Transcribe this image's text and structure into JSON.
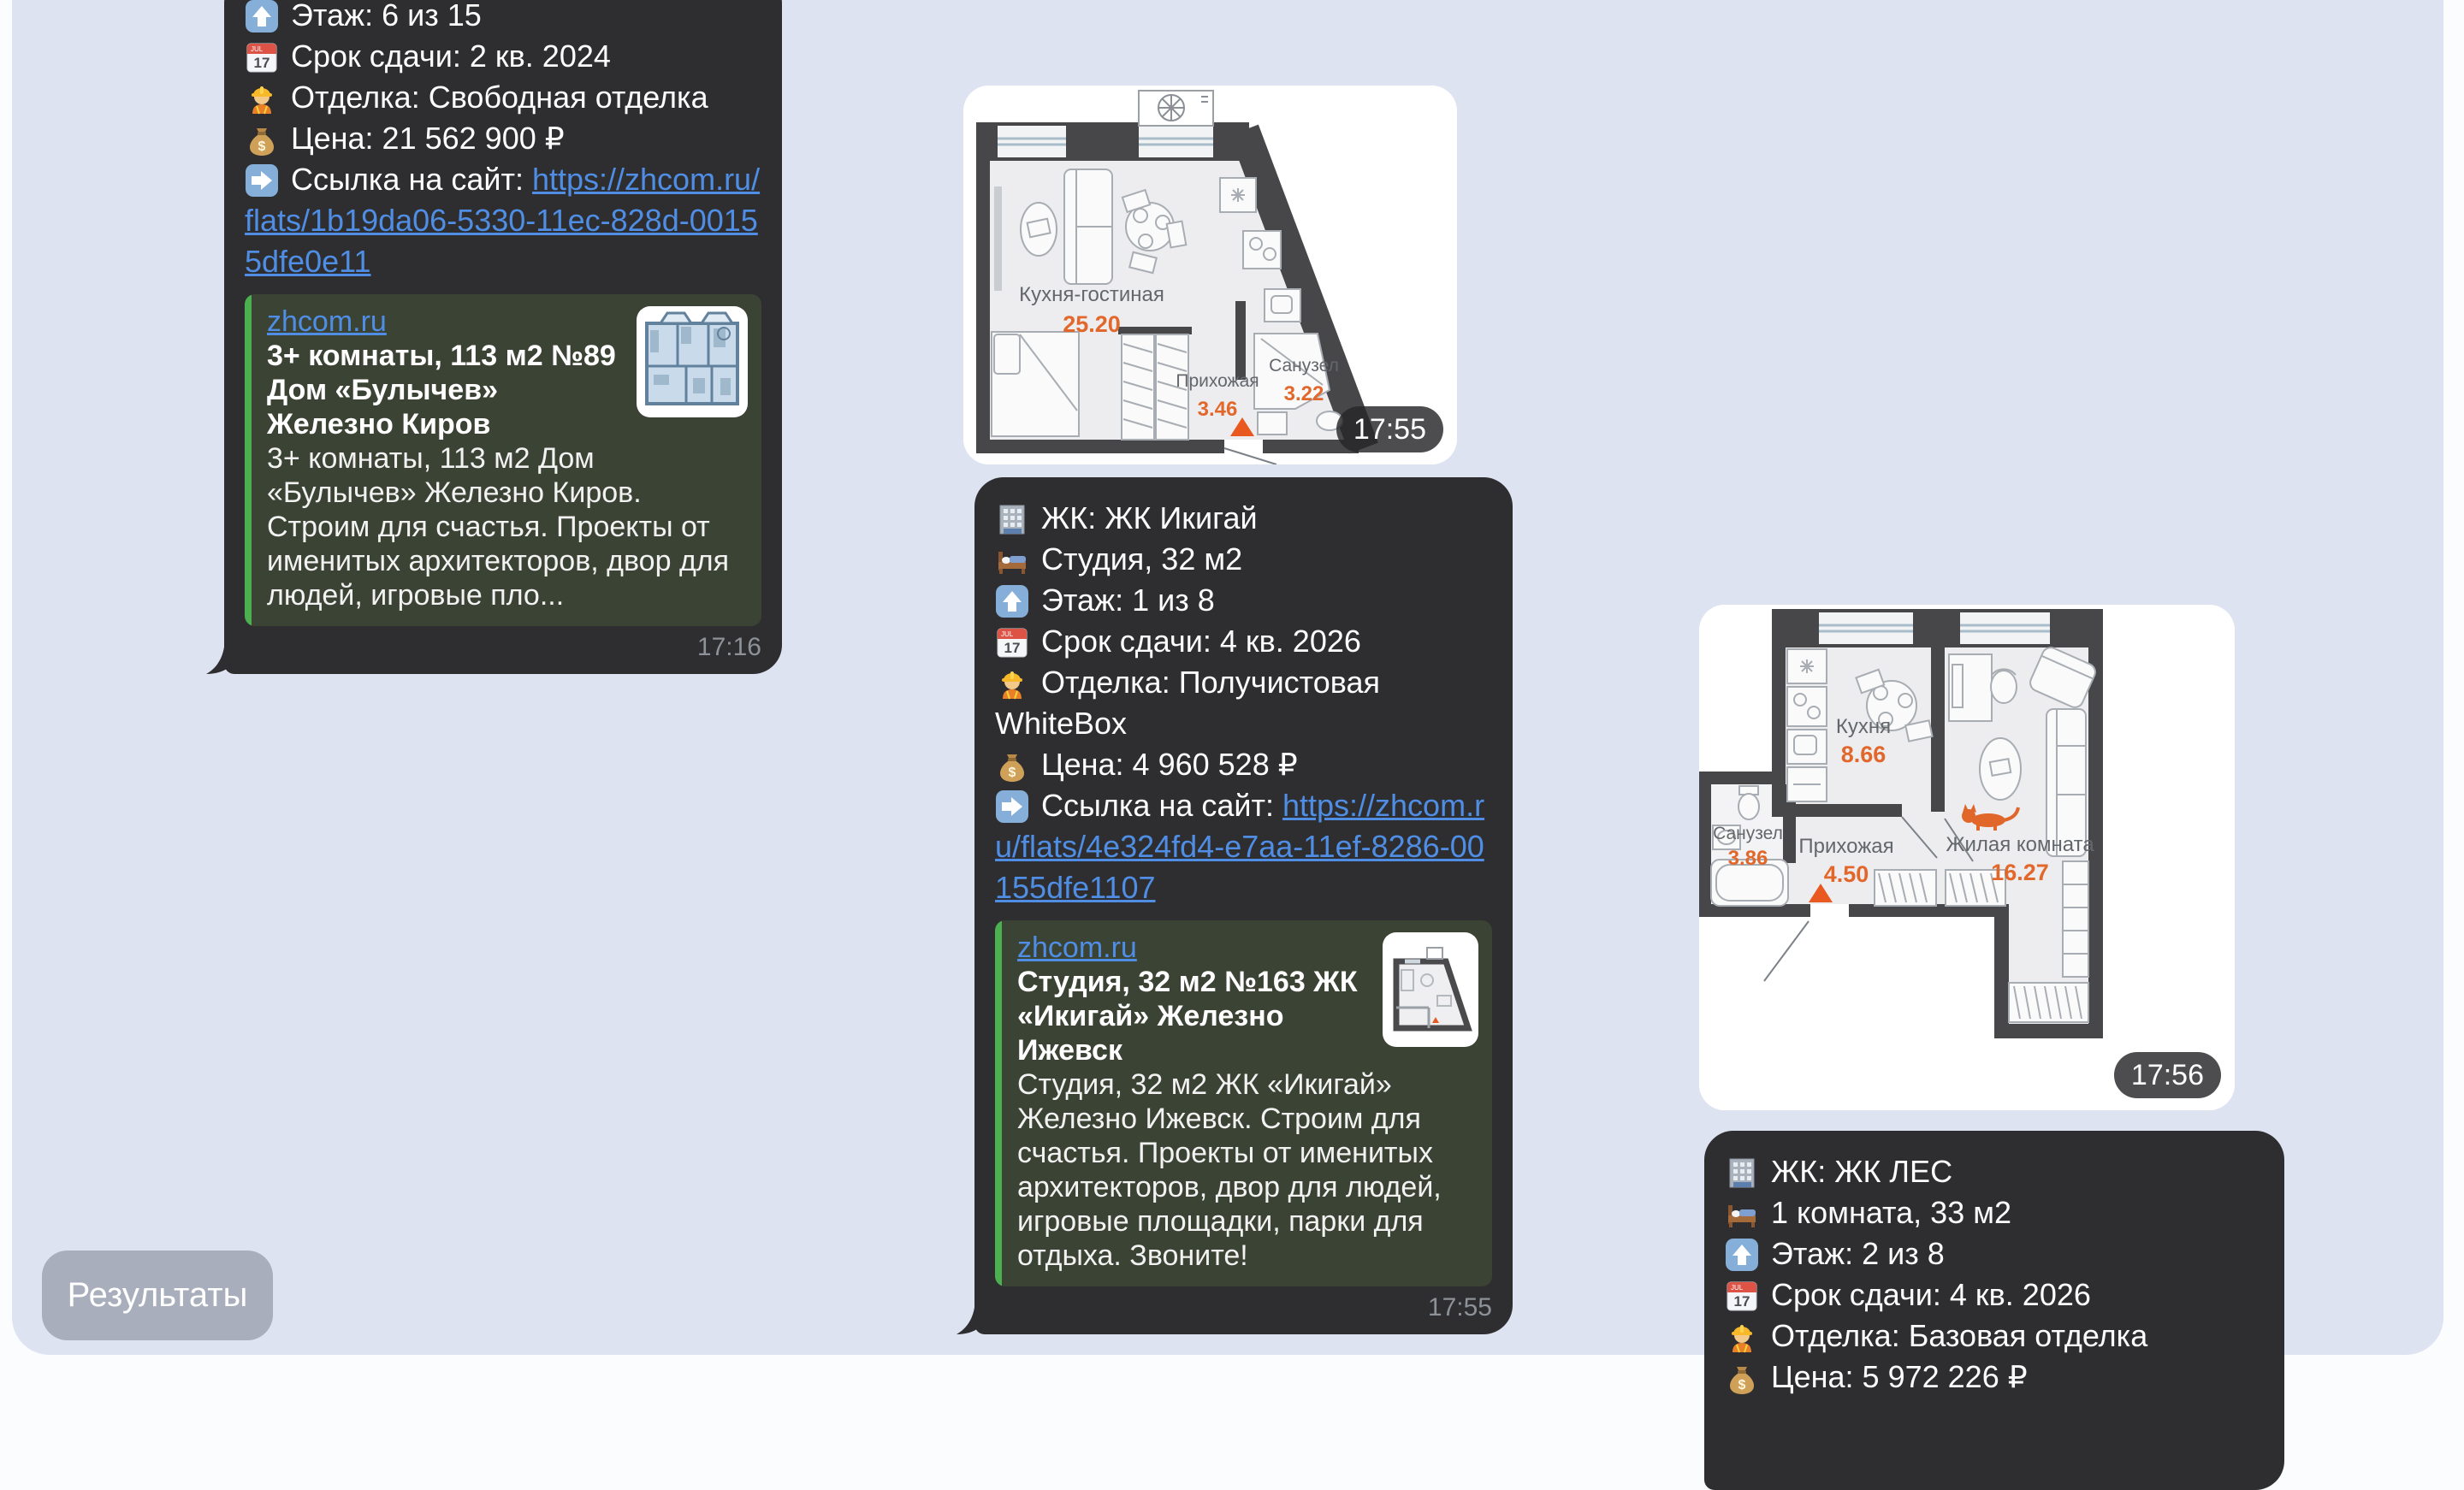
{
  "colors": {
    "page_bg": "#dee3f1",
    "bubble_bg": "#2e2e30",
    "preview_bg": "#3b4334",
    "preview_accent_green": "#4caf50",
    "link_blue": "#4f8ee4",
    "text_white": "#fdfdfd",
    "time_gray": "#8d9298",
    "button_gray": "#a8aebc",
    "plan_area_orange": "#e2672a",
    "plan_wall_dark": "#47474a"
  },
  "chat": {
    "reply_button_label": "Результаты",
    "messages": {
      "m1": {
        "lines": [
          {
            "icon": "arrow-up-icon",
            "text": "Этаж: 6 из 15"
          },
          {
            "icon": "calendar-icon",
            "text": "Срок сдачи: 2 кв. 2024"
          },
          {
            "icon": "worker-icon",
            "text": "Отделка: Свободная отделка"
          },
          {
            "icon": "moneybag-icon",
            "text": "Цена: 21 562 900 ₽"
          }
        ],
        "link_line": {
          "icon": "arrow-right-icon",
          "prefix": "Ссылка на сайт: ",
          "url": "https://zhcom.ru/flats/1b19da06-5330-11ec-828d-00155dfe0e11"
        },
        "preview": {
          "site": "zhcom.ru",
          "title": "3+ комнаты, 113 м2 №89 Дом «Булычев» Железно Киров",
          "description": "3+ комнаты, 113 м2 Дом «Булычев» Железно Киров. Строим для счастья. Проекты от именитых архитекторов, двор для людей, игровые пло..."
        },
        "time": "17:16"
      },
      "m2": {
        "lines": [
          {
            "icon": "building-icon",
            "text": "ЖК: ЖК Икигай"
          },
          {
            "icon": "bed-icon",
            "text": "Студия, 32 м2"
          },
          {
            "icon": "arrow-up-icon",
            "text": "Этаж: 1 из 8"
          },
          {
            "icon": "calendar-icon",
            "text": "Срок сдачи: 4 кв. 2026"
          },
          {
            "icon": "worker-icon",
            "text": "Отделка: Получистовая WhiteBox"
          },
          {
            "icon": "moneybag-icon",
            "text": "Цена: 4 960 528 ₽"
          }
        ],
        "link_line": {
          "icon": "arrow-right-icon",
          "prefix": "Ссылка на сайт: ",
          "url": "https://zhcom.ru/flats/4e324fd4-e7aa-11ef-8286-00155dfe1107"
        },
        "preview": {
          "site": "zhcom.ru",
          "title": "Студия, 32 м2 №163 ЖК «Икигай» Железно Ижевск",
          "description": "Студия, 32 м2 ЖК «Икигай» Железно Ижевск. Строим для счастья. Проекты от именитых архитекторов, двор для людей, игровые площадки, парки для отдыха. Звоните!"
        },
        "time": "17:55"
      },
      "m3": {
        "lines": [
          {
            "icon": "building-icon",
            "text": "ЖК: ЖК ЛЕС"
          },
          {
            "icon": "bed-icon",
            "text": "1 комната, 33 м2"
          },
          {
            "icon": "arrow-up-icon",
            "text": "Этаж: 2 из 8"
          },
          {
            "icon": "calendar-icon",
            "text": "Срок сдачи: 4 кв. 2026"
          },
          {
            "icon": "worker-icon",
            "text": "Отделка: Базовая отделка"
          },
          {
            "icon": "moneybag-icon",
            "text": "Цена: 5 972 226 ₽"
          }
        ]
      }
    },
    "photos": {
      "p1": {
        "time": "17:55",
        "rooms": [
          {
            "name": "Кухня-гостиная",
            "area": "25.20"
          },
          {
            "name": "Прихожая",
            "area": "3.46"
          },
          {
            "name": "Санузел",
            "area": "3.22"
          }
        ]
      },
      "p2": {
        "time": "17:56",
        "rooms": [
          {
            "name": "Кухня",
            "area": "8.66"
          },
          {
            "name": "Санузел",
            "area": "3.86"
          },
          {
            "name": "Прихожая",
            "area": "4.50"
          },
          {
            "name": "Жилая комната",
            "area": "16.27"
          }
        ]
      }
    }
  }
}
